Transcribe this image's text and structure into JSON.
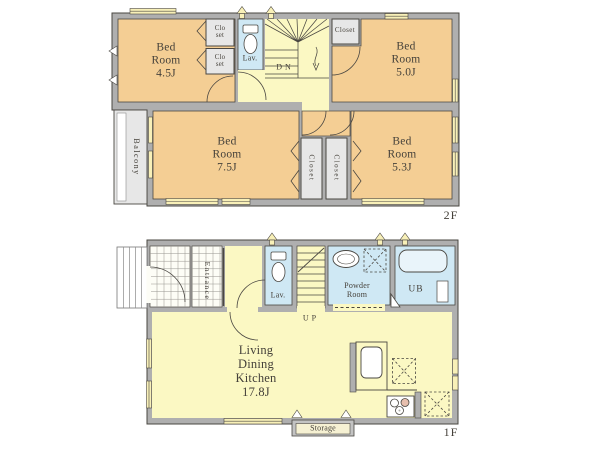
{
  "colors": {
    "bedroom_fill": "#F4CE94",
    "hall_fill": "#FBF8C3",
    "wet_area_fill": "#CFE8F4",
    "wall_fill": "#AFAFAF",
    "closet_fill": "#E7E7E7",
    "window_fill": "#F8F0B8",
    "text_color": "#45413A",
    "line_color": "#4A4742"
  },
  "floor2": {
    "floor_label": "2F",
    "bedroom_45": "Bed\nRoom\n4.5J",
    "bedroom_50": "Bed\nRoom\n5.0J",
    "bedroom_75": "Bed\nRoom\n7.5J",
    "bedroom_53": "Bed\nRoom\n5.3J",
    "closet_small_1": "Clo\nset",
    "closet_small_2": "Clo\nset",
    "closet_right": "Closet",
    "closet_v1": "Closet",
    "closet_v2": "Closet",
    "lavatory": "Lav.",
    "stairs_down": "DN",
    "balcony": "Balcony"
  },
  "floor1": {
    "floor_label": "1F",
    "entrance": "Entrance",
    "lavatory": "Lav.",
    "stairs_up": "UP",
    "powder_room": "Powder\nRoom",
    "unit_bath": "UB",
    "ldk": "Living\nDining\nKitchen\n17.8J",
    "storage": "Storage"
  }
}
